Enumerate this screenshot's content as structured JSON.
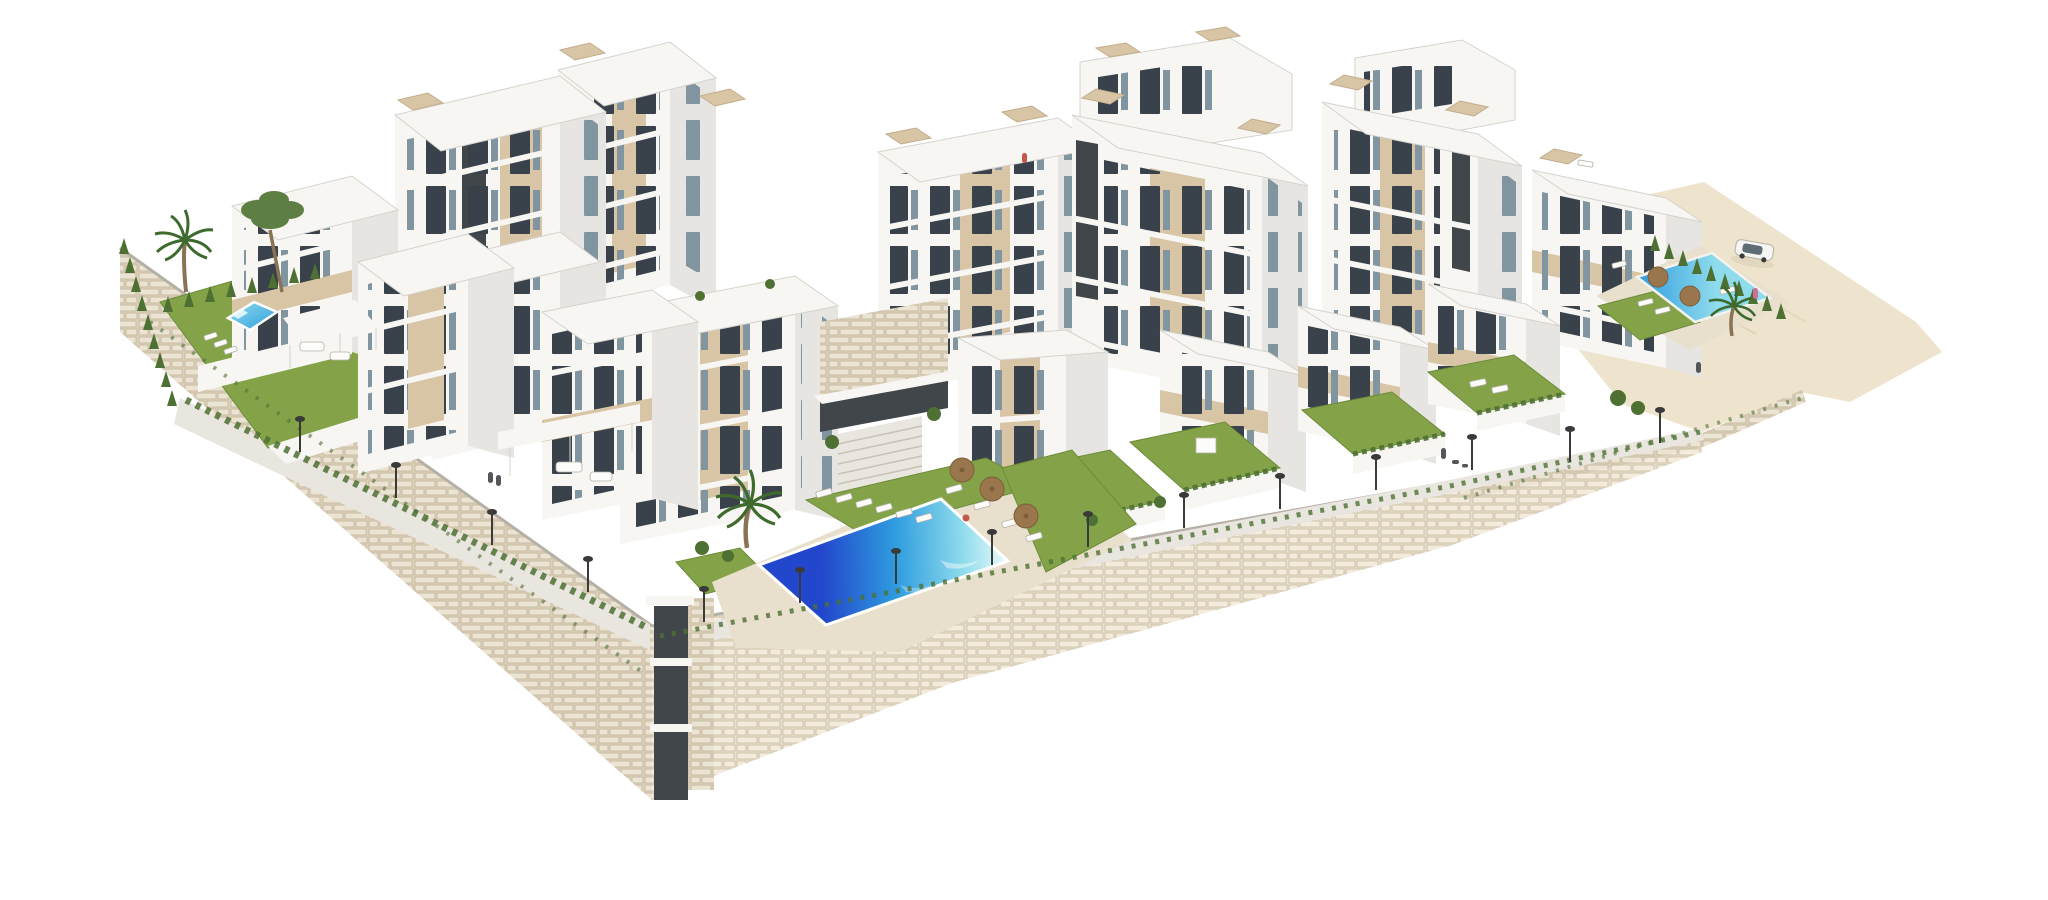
{
  "meta": {
    "title": "Aerial 3D architectural render of a modern hillside residential complex",
    "image_type": "architectural visualization (CGI render), no text or UI elements visible",
    "background": "plain white"
  },
  "scene": {
    "setting": "Stepped hillside site seen from an elevated angle, enclosed by curved beige stone retaining walls that taper to a corner at the bottom centre-left",
    "buildings": {
      "count_approx": 12,
      "style": "white modern stacked cubic apartment blocks and townhouses, beige recessed window bays, dark vertical stair shafts, white balcony slabs with glass railings, beige slatted rooftop pergolas"
    },
    "pools": [
      {
        "id": "left-garden-pool",
        "desc": "small turquoise private pool in the left walled garden"
      },
      {
        "id": "main-communal-pool",
        "desc": "large communal pool at the centre, deep blue at the near end fading to pale turquoise, surrounded by lawn, white sun loungers and straw parasols"
      },
      {
        "id": "right-communal-pool",
        "desc": "medium turquoise pool on the upper-right terrace with parasols and loungers"
      }
    ],
    "landscape": {
      "lawns": 10,
      "cypress_hedges": 3,
      "palm_trees": 3,
      "pine_trees": 1,
      "street_lamps": 15,
      "parasols": 6,
      "sun_loungers": 20,
      "stone_walls": "rubble-stone retaining walls with grass tufts along the top edges",
      "terrain": "bare sandy ground on the far right with a parked white car"
    },
    "staffage": "small human figures on promenades, a swimmer at the main pool, a figure on a rooftop, a person walking dogs, central external stair/lift shaft descending the main wall"
  },
  "palette": {
    "bg": "#ffffff",
    "building_white": "#f7f6f3",
    "building_side": "#e7e5e1",
    "building_shadow": "#d5d3ce",
    "beige_panel": "#d8c5a6",
    "beige_dark": "#c2ad8b",
    "dark_shaft": "#41464b",
    "window_dark": "#39414a",
    "window_glass": "#8195a0",
    "railing": "#c3d2d8",
    "stone_bg": "#ddd2bc",
    "stone_block": "#ece4d3",
    "stone_bg2": "#e7dfcd",
    "stone_block2": "#f3ecdd",
    "stone_joint": "#c8baa0",
    "path_gray": "#e9e6e0",
    "deck_beige": "#e8e0cd",
    "curb": "#b5b0a6",
    "step_line": "#c9c2b4",
    "terrain_sand": "#eee3cc",
    "terrain_line": "#d9c9a9",
    "lawn_green": "#84a348",
    "lawn_dark": "#6d8c3a",
    "hedge_green": "#4e7033",
    "palm_green": "#3e6a2e",
    "pine_green": "#5e7f44",
    "trunk_brown": "#8a7355",
    "pool_deep": "#2347cc",
    "pool_mid": "#2f9ddf",
    "pool_light": "#8fdcec",
    "pool_foam": "#ecfbfc",
    "pool_edge": "#f4f2ee",
    "umbrella_brown": "#9a764c",
    "umbrella_dark": "#7d5e3a",
    "lounger_white": "#fcfcfb",
    "lamp_dark": "#3a3a3a",
    "fig_dark": "#53565a",
    "fig_red": "#c4574a",
    "fig_pink": "#cf6f95",
    "car_white": "#f5f5f3",
    "car_glass": "#5f6b75"
  }
}
